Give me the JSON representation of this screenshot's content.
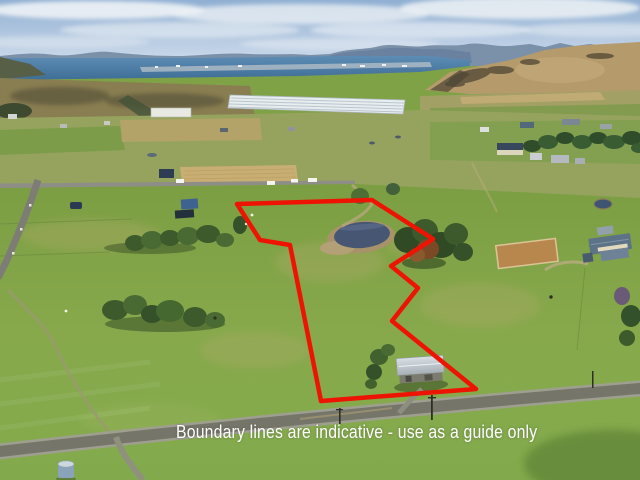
{
  "image": {
    "caption": "Boundary lines are indicative - use as a guide only",
    "caption_color": "#ffffff"
  },
  "overlay": {
    "boundary_color": "#ee1404",
    "boundary_stroke_width": "4.5",
    "boundary_points": "237,204 372,200 433,239 391,266 418,288 392,321 476,389 321,401 290,245 260,240"
  }
}
